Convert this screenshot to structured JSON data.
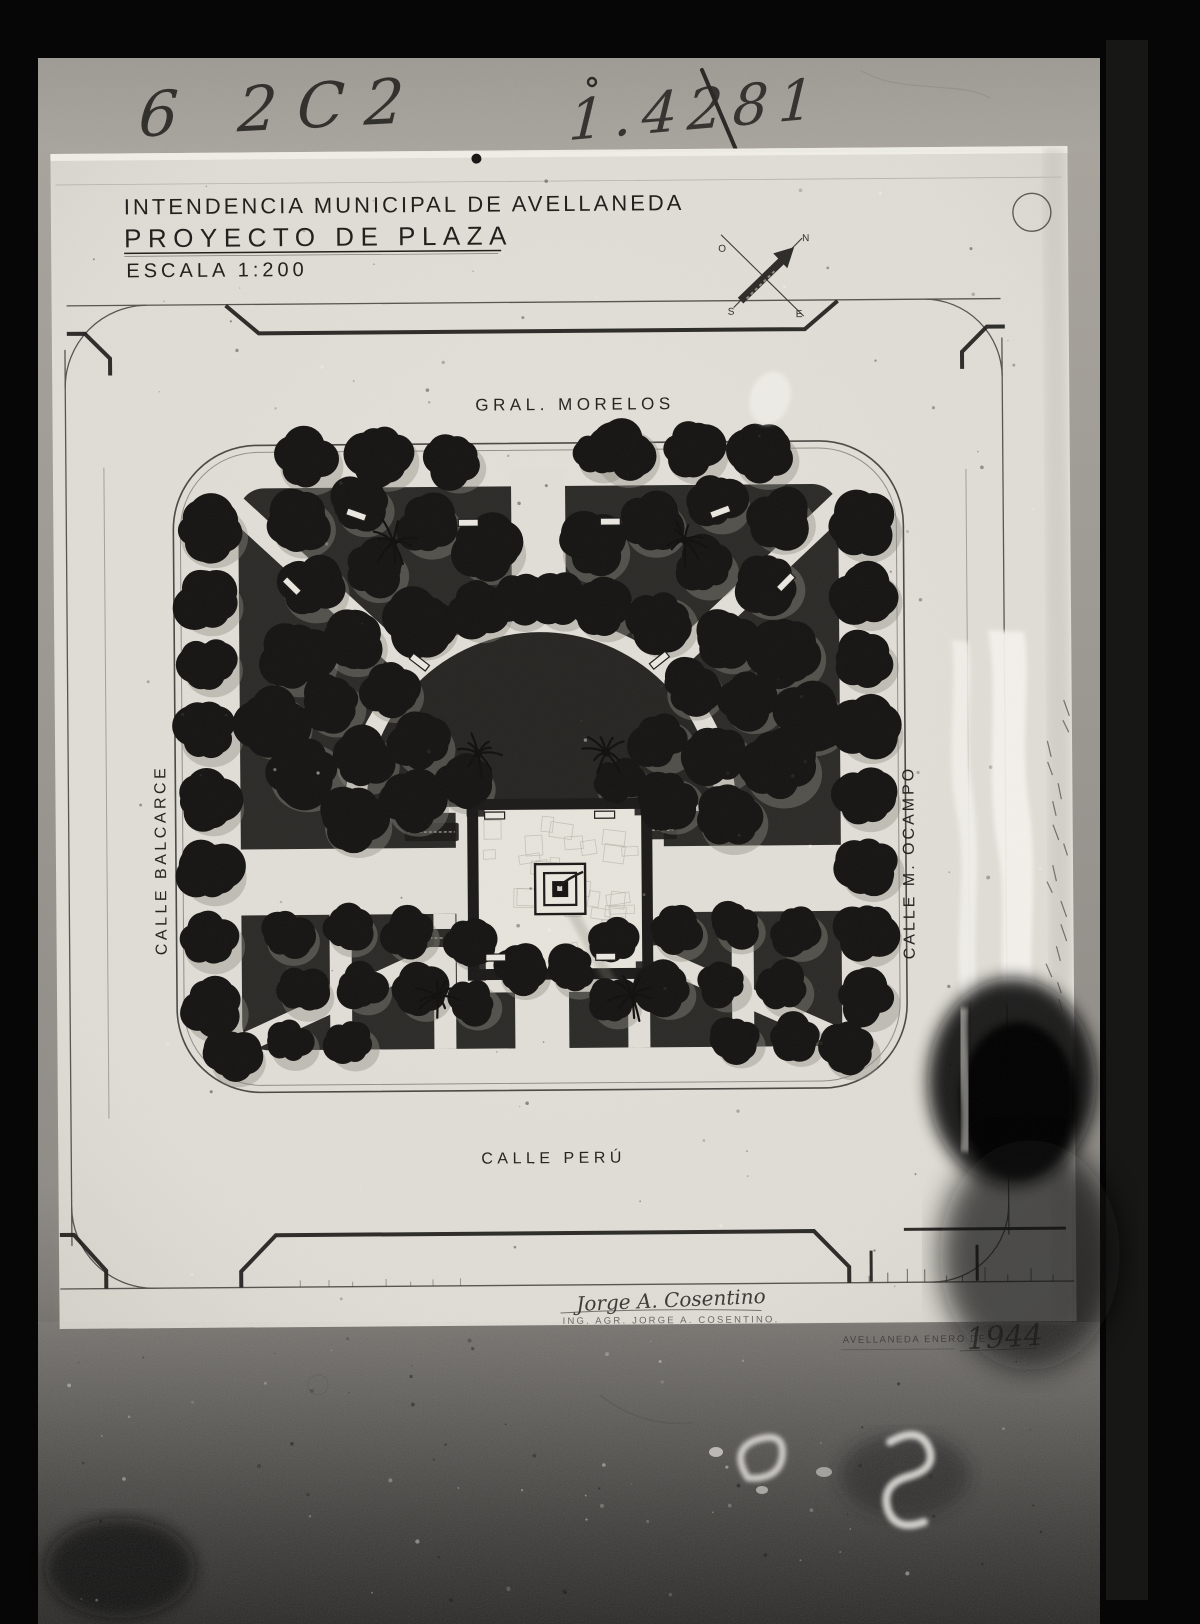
{
  "photo": {
    "archive_marks": {
      "top_left_number": "6 2C2",
      "top_right_number": "1.4281",
      "bottom_ghost_marks": "C S"
    }
  },
  "drawing": {
    "title_block": {
      "line1": "INTENDENCIA MUNICIPAL DE AVELLANEDA",
      "line2": "PROYECTO DE PLAZA",
      "line3": "ESCALA  1:200"
    },
    "compass": {
      "n": "N",
      "s": "S",
      "e": "E",
      "o": "O"
    },
    "streets": {
      "north": "GRAL. MORELOS",
      "west": "CALLE  BALCARCE",
      "east": "CALLE  M. OCAMPO",
      "south": "CALLE  PERÚ"
    },
    "signature": {
      "script": "Jorge A. Cosentino",
      "stamp": "ING. AGR. JORGE A. COSENTINO."
    },
    "dateline": {
      "stamp": "AVELLANEDA ENERO DE",
      "year": "1944"
    }
  },
  "plan": {
    "colors": {
      "ink": "#1b1a17",
      "canopy": "#151412",
      "halo": "#8f8c82",
      "paper": "#e0ded6",
      "parterre": "#2b2a27",
      "semicircle": "#262522"
    },
    "perimeter_trees": [
      [
        308,
        457,
        30
      ],
      [
        383,
        453,
        31
      ],
      [
        455,
        460,
        26
      ],
      [
        600,
        453,
        24
      ],
      [
        625,
        452,
        30
      ],
      [
        694,
        450,
        29
      ],
      [
        764,
        455,
        30
      ],
      [
        210,
        527,
        32
      ],
      [
        207,
        597,
        30
      ],
      [
        208,
        660,
        28
      ],
      [
        206,
        728,
        30
      ],
      [
        207,
        798,
        29
      ],
      [
        208,
        867,
        30
      ],
      [
        207,
        936,
        29
      ],
      [
        209,
        1004,
        30
      ],
      [
        230,
        1052,
        26
      ],
      [
        864,
        527,
        32
      ],
      [
        866,
        597,
        30
      ],
      [
        864,
        662,
        28
      ],
      [
        866,
        730,
        30
      ],
      [
        864,
        799,
        29
      ],
      [
        866,
        868,
        30
      ],
      [
        864,
        934,
        29
      ],
      [
        863,
        1000,
        28
      ],
      [
        845,
        1050,
        26
      ]
    ],
    "parterre_trees": [
      [
        300,
        520,
        30
      ],
      [
        362,
        502,
        27
      ],
      [
        428,
        523,
        29
      ],
      [
        488,
        546,
        32
      ],
      [
        312,
        584,
        31
      ],
      [
        375,
        567,
        28
      ],
      [
        296,
        654,
        35
      ],
      [
        352,
        640,
        29
      ],
      [
        420,
        621,
        32
      ],
      [
        478,
        608,
        28
      ],
      [
        520,
        599,
        26
      ],
      [
        272,
        719,
        33
      ],
      [
        331,
        701,
        28
      ],
      [
        390,
        688,
        27
      ],
      [
        302,
        768,
        36
      ],
      [
        362,
        757,
        30
      ],
      [
        420,
        741,
        28
      ],
      [
        352,
        818,
        32
      ],
      [
        412,
        800,
        29
      ],
      [
        462,
        781,
        26
      ],
      [
        780,
        520,
        30
      ],
      [
        718,
        502,
        27
      ],
      [
        652,
        523,
        29
      ],
      [
        592,
        546,
        32
      ],
      [
        768,
        584,
        31
      ],
      [
        705,
        567,
        28
      ],
      [
        784,
        654,
        35
      ],
      [
        728,
        640,
        29
      ],
      [
        660,
        621,
        32
      ],
      [
        602,
        608,
        28
      ],
      [
        560,
        599,
        26
      ],
      [
        808,
        719,
        33
      ],
      [
        749,
        701,
        28
      ],
      [
        690,
        688,
        27
      ],
      [
        778,
        768,
        36
      ],
      [
        718,
        757,
        30
      ],
      [
        660,
        741,
        28
      ],
      [
        728,
        818,
        32
      ],
      [
        668,
        800,
        29
      ],
      [
        618,
        781,
        26
      ],
      [
        286,
        932,
        25
      ],
      [
        346,
        926,
        23
      ],
      [
        406,
        931,
        25
      ],
      [
        300,
        988,
        25
      ],
      [
        360,
        984,
        23
      ],
      [
        418,
        989,
        25
      ],
      [
        287,
        1039,
        23
      ],
      [
        347,
        1040,
        23
      ],
      [
        468,
        941,
        23
      ],
      [
        470,
        1000,
        23
      ],
      [
        794,
        932,
        25
      ],
      [
        734,
        926,
        23
      ],
      [
        674,
        931,
        25
      ],
      [
        780,
        988,
        25
      ],
      [
        720,
        984,
        23
      ],
      [
        662,
        989,
        25
      ],
      [
        793,
        1039,
        23
      ],
      [
        733,
        1040,
        23
      ],
      [
        612,
        941,
        23
      ],
      [
        610,
        1000,
        23
      ],
      [
        518,
        969,
        24
      ],
      [
        571,
        969,
        24
      ]
    ],
    "palms": [
      [
        478,
        753
      ],
      [
        606,
        753
      ],
      [
        395,
        541
      ],
      [
        686,
        541
      ],
      [
        436,
        996
      ],
      [
        630,
        996
      ]
    ],
    "benches": [
      [
        494,
        815,
        0
      ],
      [
        604,
        815,
        0
      ],
      [
        494,
        957,
        0
      ],
      [
        604,
        957,
        0
      ],
      [
        470,
        522,
        0
      ],
      [
        612,
        522,
        0
      ],
      [
        293,
        584,
        45
      ],
      [
        787,
        584,
        -45
      ],
      [
        420,
        661,
        38
      ],
      [
        660,
        661,
        -38
      ],
      [
        358,
        513,
        20
      ],
      [
        722,
        513,
        -20
      ]
    ],
    "flower_strips": [
      [
        404,
        822
      ],
      [
        622,
        822
      ],
      [
        404,
        928
      ],
      [
        622,
        928
      ]
    ]
  }
}
